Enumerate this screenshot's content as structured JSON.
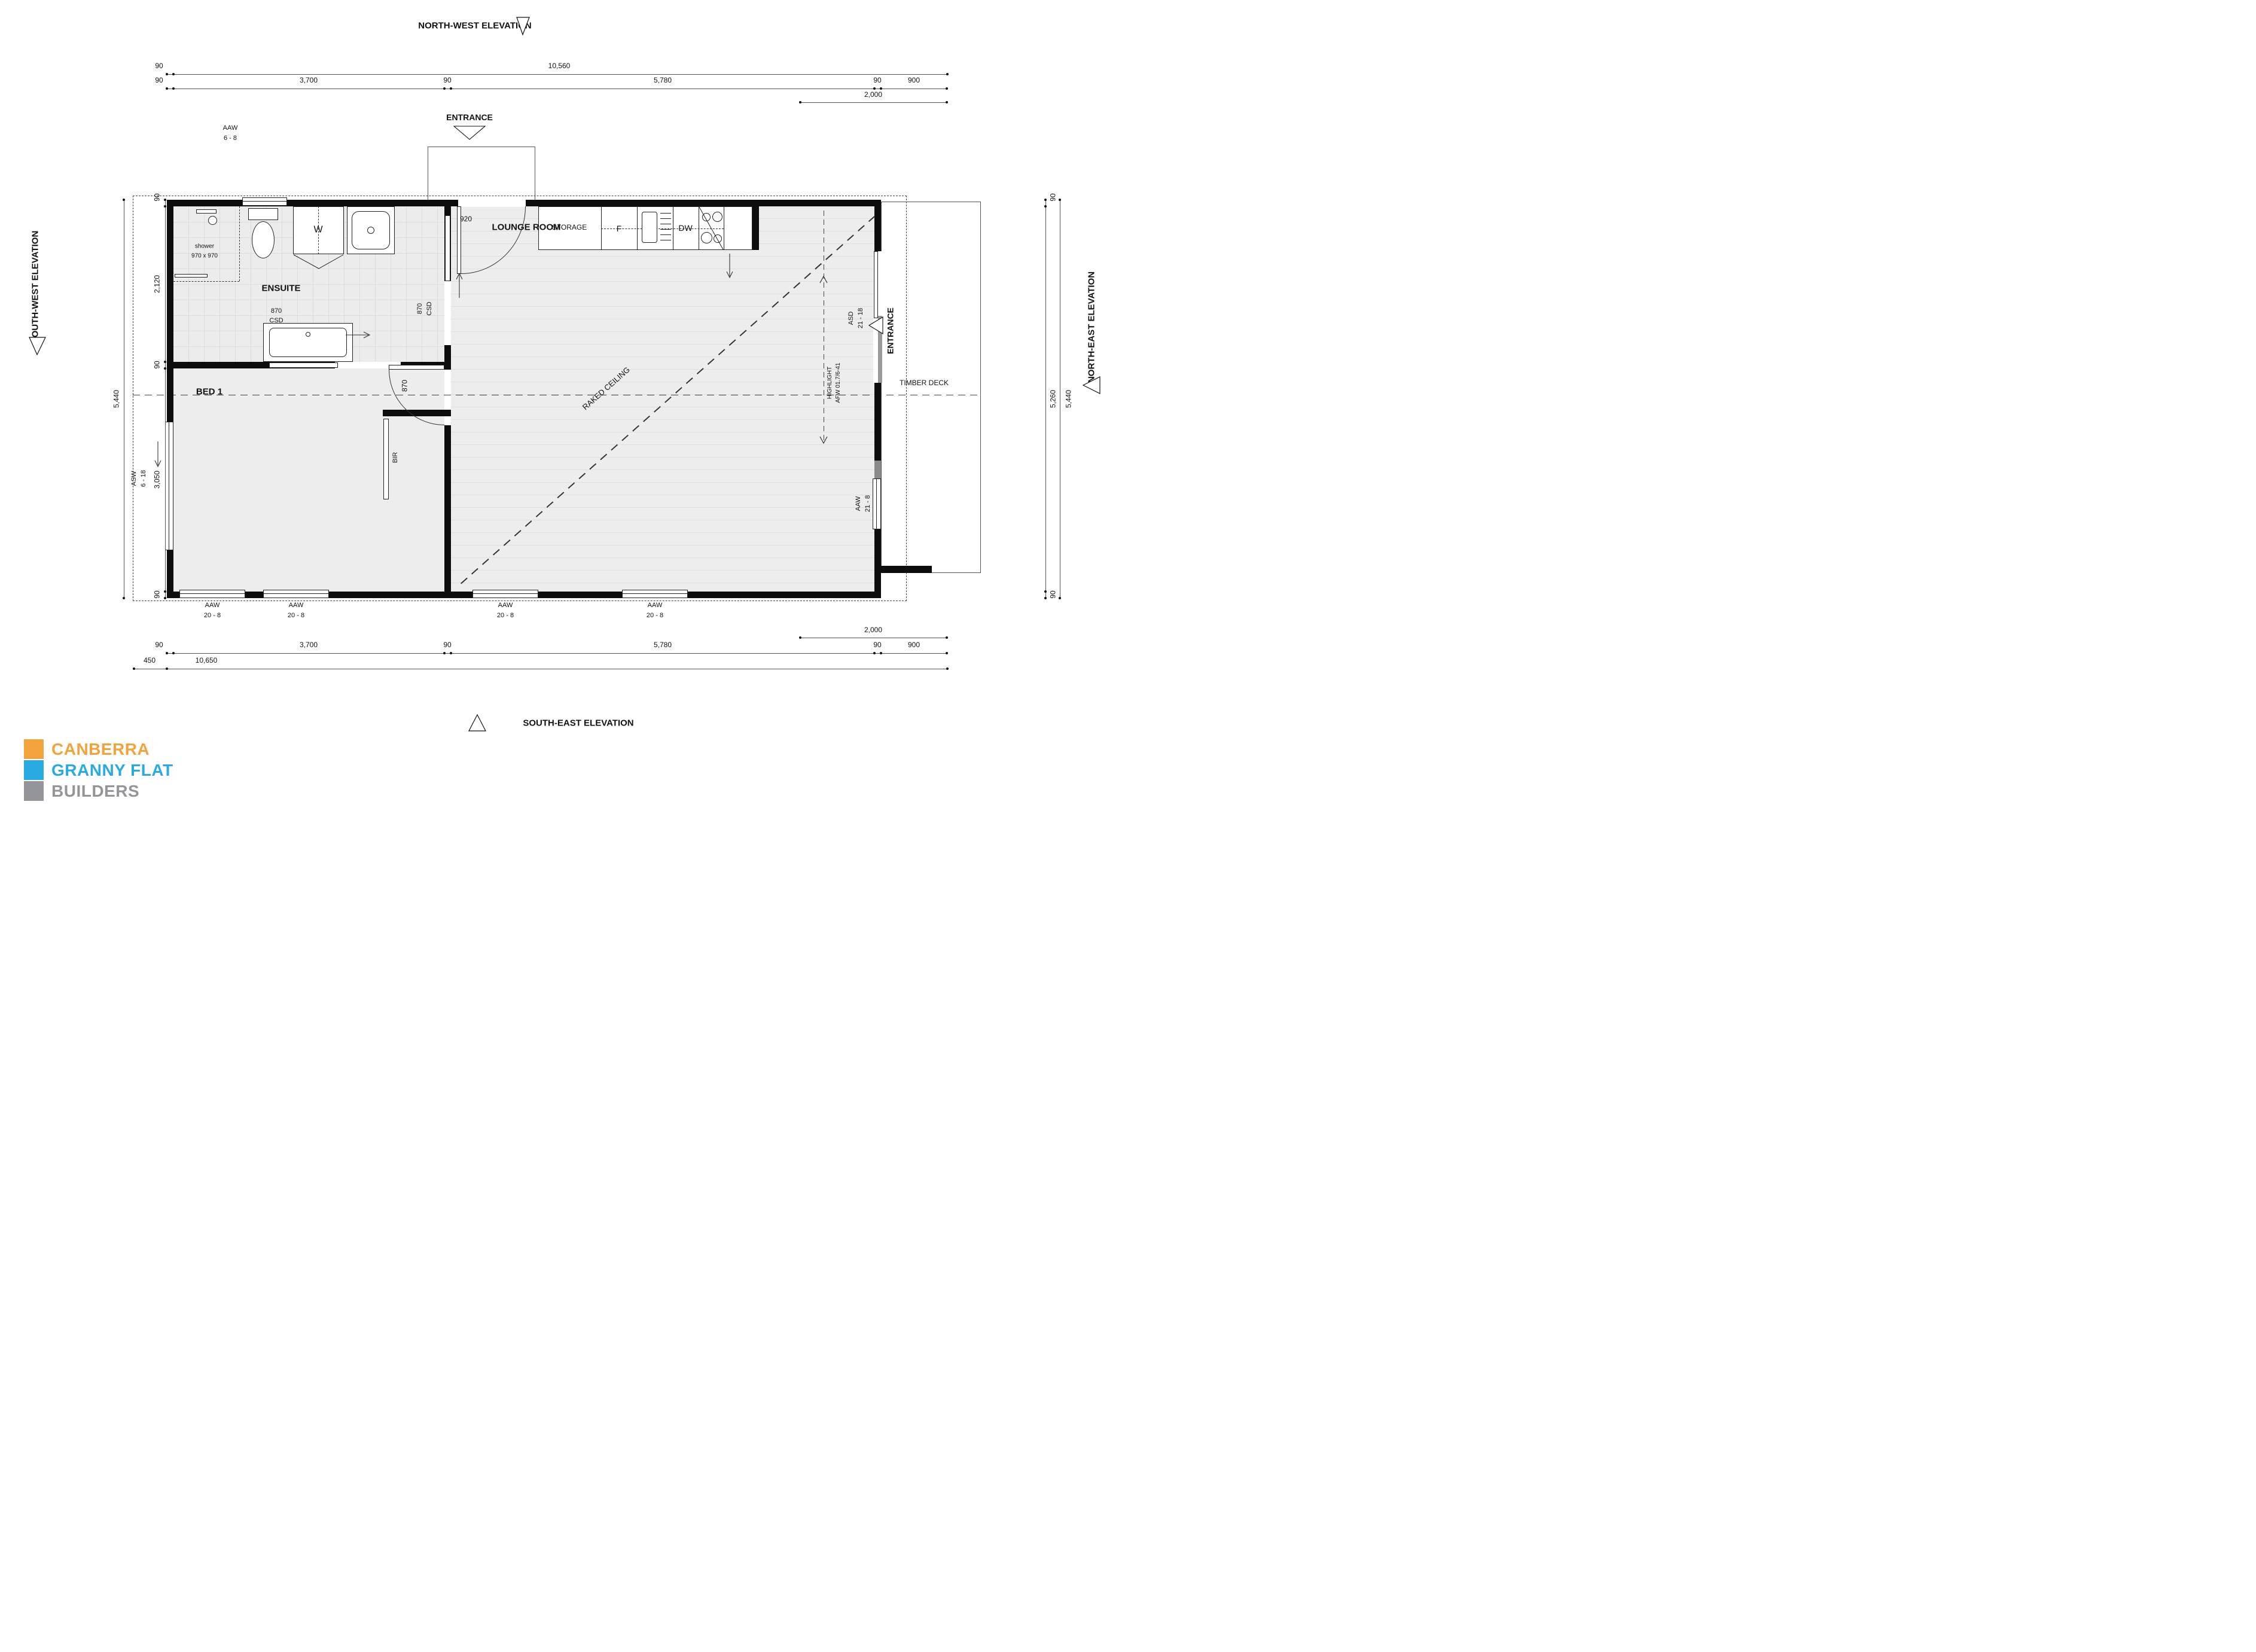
{
  "elevations": {
    "north_west": "NORTH-WEST ELEVATION",
    "south_east": "SOUTH-EAST ELEVATION",
    "south_west": "SOUTH-WEST ELEVATION",
    "north_east": "NORTH-EAST ELEVATION"
  },
  "entrance": {
    "top": "ENTRANCE",
    "side": "ENTRANCE"
  },
  "rooms": {
    "ensuite": "ENSUITE",
    "bed1": "BED 1",
    "lounge": "LOUNGE ROOM",
    "storage": "STORAGE",
    "timber_deck": "TIMBER DECK"
  },
  "fixtures": {
    "shower_name": "shower",
    "shower_size": "970 x 970",
    "washer": "W",
    "fridge": "F",
    "dishwasher": "DW",
    "robe": "BIR"
  },
  "doors": {
    "front_width": "920",
    "bed_width": "870",
    "csd_width": "870",
    "csd_type": "CSD",
    "asd_code": "ASD",
    "asd_size": "21 - 18"
  },
  "windows": {
    "aaw": "AAW",
    "asw": "ASW",
    "top_size": "6 - 8",
    "left_size": "6 - 18",
    "right_size": "21 - 8",
    "bottom_size": "20 - 8"
  },
  "ceiling": {
    "raked": "RAKED CEILING",
    "highlight": "HIGHLIGHT",
    "highlight_code": "AFW 01.7/6-41"
  },
  "dims": {
    "d90": "90",
    "d450": "450",
    "d900": "900",
    "d920": "920",
    "d2000": "2,000",
    "d2120": "2,120",
    "d3050": "3,050",
    "d3700": "3,700",
    "d5260": "5,260",
    "d5440": "5,440",
    "d5780": "5,780",
    "d10560": "10,560",
    "d10650": "10,650"
  },
  "logo": {
    "line1": "CANBERRA",
    "line2": "GRANNY FLAT",
    "line3": "BUILDERS",
    "orange": "#F2A33B",
    "blue": "#29ABE2",
    "gray": "#939598"
  }
}
